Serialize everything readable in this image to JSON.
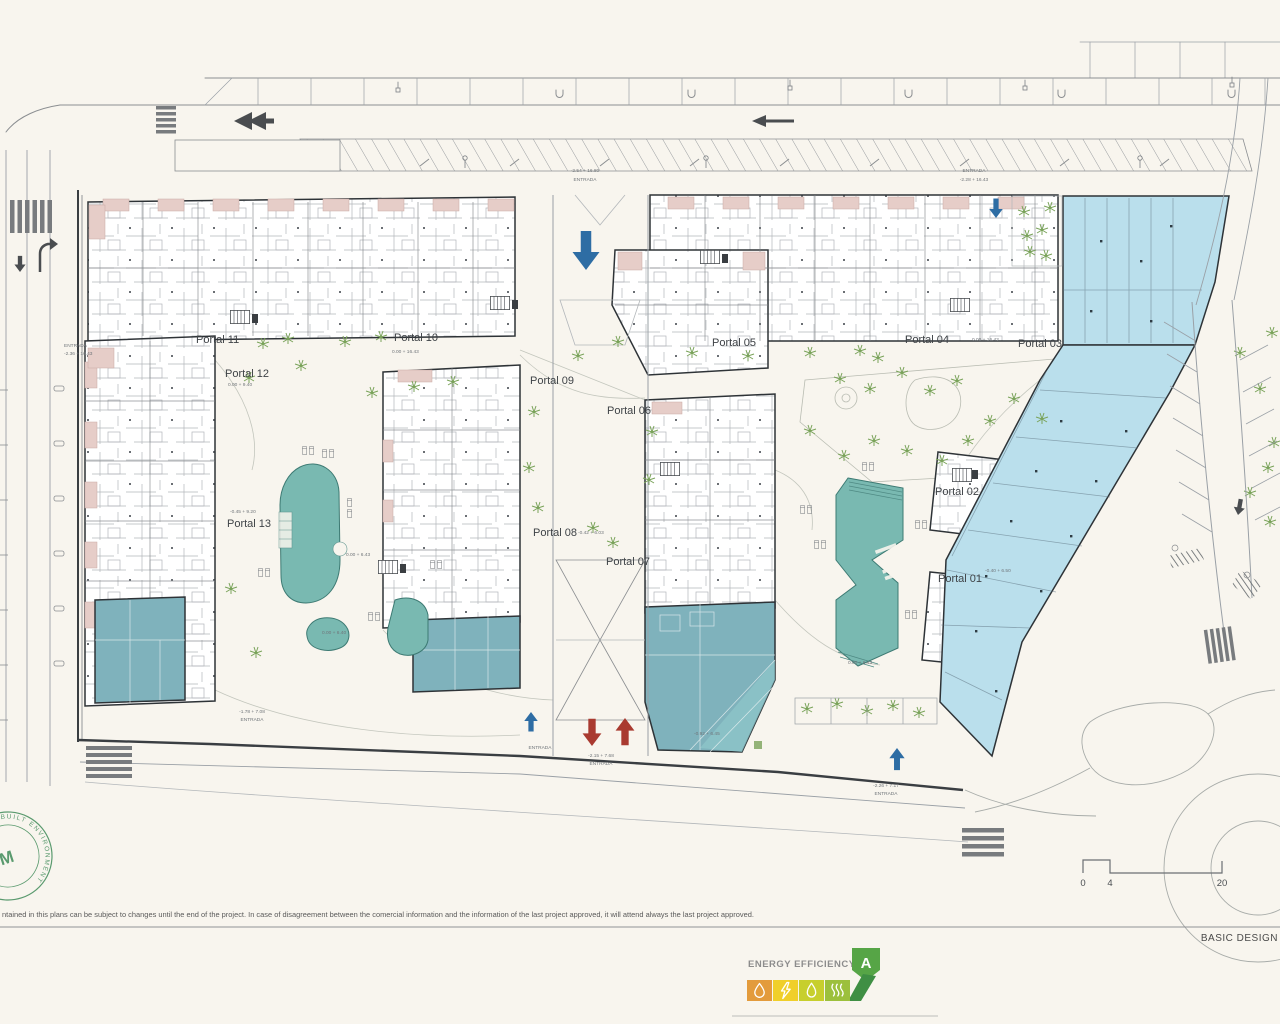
{
  "plan": {
    "portals": [
      {
        "label": "Portal 01"
      },
      {
        "label": "Portal 02"
      },
      {
        "label": "Portal 03"
      },
      {
        "label": "Portal 04"
      },
      {
        "label": "Portal 05"
      },
      {
        "label": "Portal 06"
      },
      {
        "label": "Portal 07"
      },
      {
        "label": "Portal 08"
      },
      {
        "label": "Portal 09"
      },
      {
        "label": "Portal 10"
      },
      {
        "label": "Portal 11"
      },
      {
        "label": "Portal 12"
      },
      {
        "label": "Portal 13"
      }
    ],
    "entrada_label": "ENTRADA",
    "elevations": {
      "top_center": "-2.54 + 16.80",
      "top_right": "-2.28 + 16.43",
      "left_entry": "-2.36 + 16.43",
      "portal_10": "0.00 + 16.43",
      "portal_03": "0.00 + 16.43",
      "portal_12": "0.00 + 9.40",
      "portal_13": "-0.45 + 9.20",
      "portal_08": "-0.42 + 6.03",
      "portal_01": "-0.40 + 6.50",
      "pool_left": "0.00 + 6.43",
      "pool_small": "0.00 + 6.40",
      "pool_right": "0.00 + 6.43",
      "commercial_center": "-0.92 + 6.45",
      "bottom_left": "-1.78 + 7.08",
      "bottom_center": "-2.15 + 7.68",
      "bottom_right": "-2.26 + 7.17"
    },
    "scale_bar": {
      "ticks": [
        "0",
        "4",
        "20"
      ]
    }
  },
  "footer": {
    "disclaimer": "ntained in this plans can be subject to changes until the end of the project. In case of disagreement between the comercial information and the information of the last project approved, it will attend always the last project approved.",
    "stage_label": "BASIC DESIGN"
  },
  "energy_badge": {
    "title": "ENERGY EFFICIENCY",
    "rating": "A"
  },
  "stamp": {
    "ring_text": "BUILT ENVIRONMENT",
    "center_text": "M"
  },
  "colors": {
    "pool": "#79b9b1",
    "commercial_light": "#badfec",
    "commercial_dark": "#7fb2bc",
    "accent_pink": "#e6cdc8",
    "tree_green": "#7aa35a",
    "stamp_green": "#5a9a6e",
    "arrow_blue": "#2e6da4",
    "arrow_red": "#a93a30",
    "badge_orange": "#e39b3c",
    "badge_yellow": "#f0cf2a",
    "badge_yellow_green": "#c7cf2d",
    "badge_green": "#9cc03c",
    "badge_rating_green": "#56a546",
    "badge_dark_green": "#3f8f44"
  }
}
